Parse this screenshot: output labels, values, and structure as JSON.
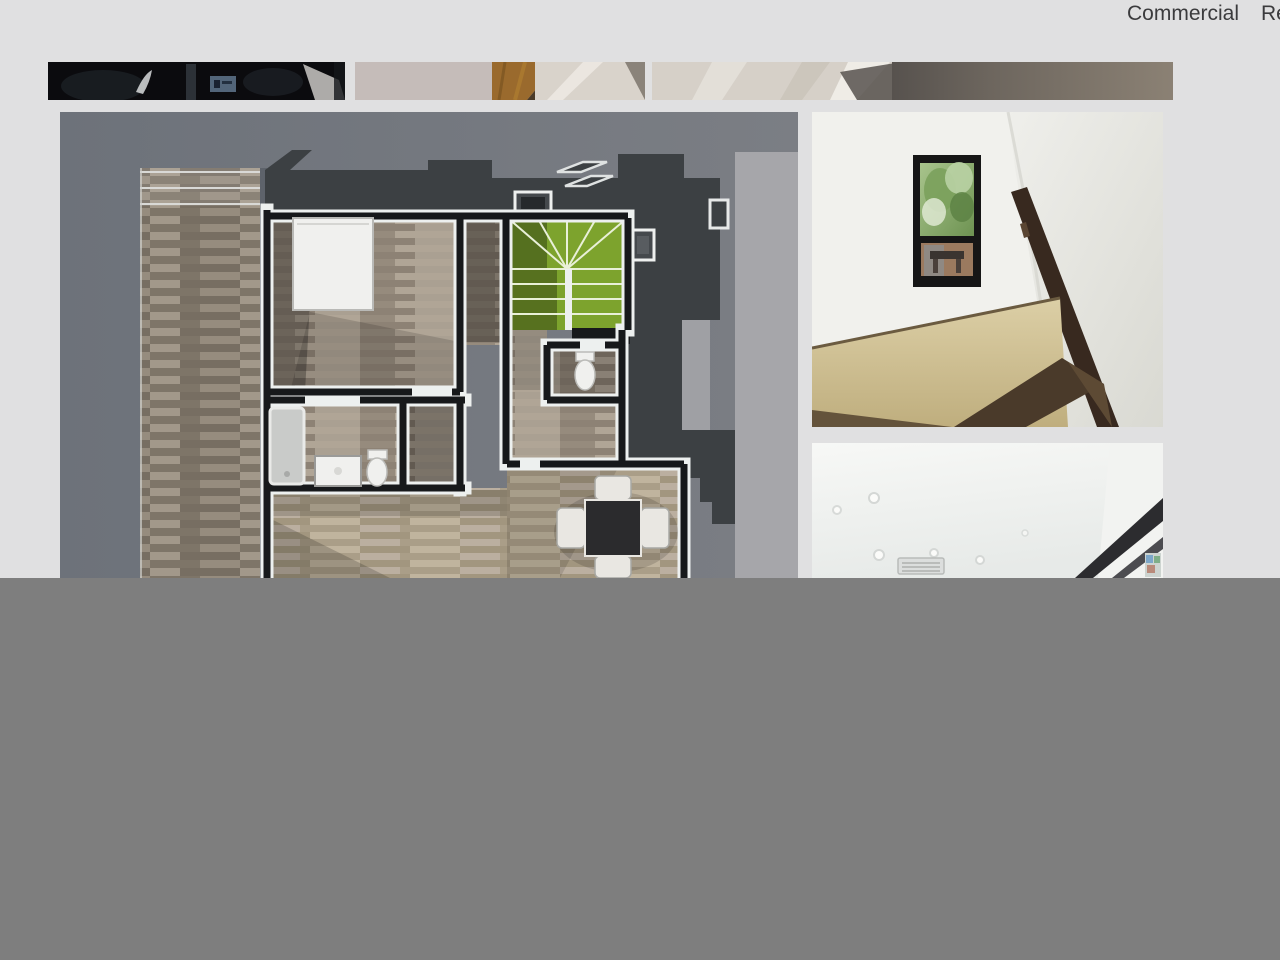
{
  "nav": {
    "items": [
      {
        "label": "Commercial"
      },
      {
        "label": "Res"
      }
    ]
  },
  "gallery": {
    "thumbnails": [
      {
        "name": "project-thumbnail-1"
      },
      {
        "name": "project-thumbnail-2"
      },
      {
        "name": "project-thumbnail-3"
      }
    ],
    "images": [
      {
        "name": "floor-plan-render"
      },
      {
        "name": "stairwell-photo"
      },
      {
        "name": "interior-ceiling-photo"
      }
    ]
  },
  "colors": {
    "page_bg": "#e0e0e1",
    "overlay": "#7e7e7e",
    "nav_text": "#3b3b3d",
    "plan_bg": "#6f747c",
    "plan_bg_light": "#a6a6aa",
    "roof": "#3c4043",
    "wall_dark": "#17191b",
    "wall_light": "#edf0ef",
    "stair_green": "#7da32d",
    "stair_green_dark": "#55701f",
    "deck_wood": "#8b8276",
    "wood_mid": "#9d9285",
    "wood_light": "#b3a792",
    "table_dark": "#2b2b2d",
    "fixture_white": "#f0f0ee",
    "photo_wall": "#f1f1ed",
    "handrail": "#38291f",
    "landing_wood": "#cfc09c",
    "thumb_dark": "#0b0b0e"
  }
}
